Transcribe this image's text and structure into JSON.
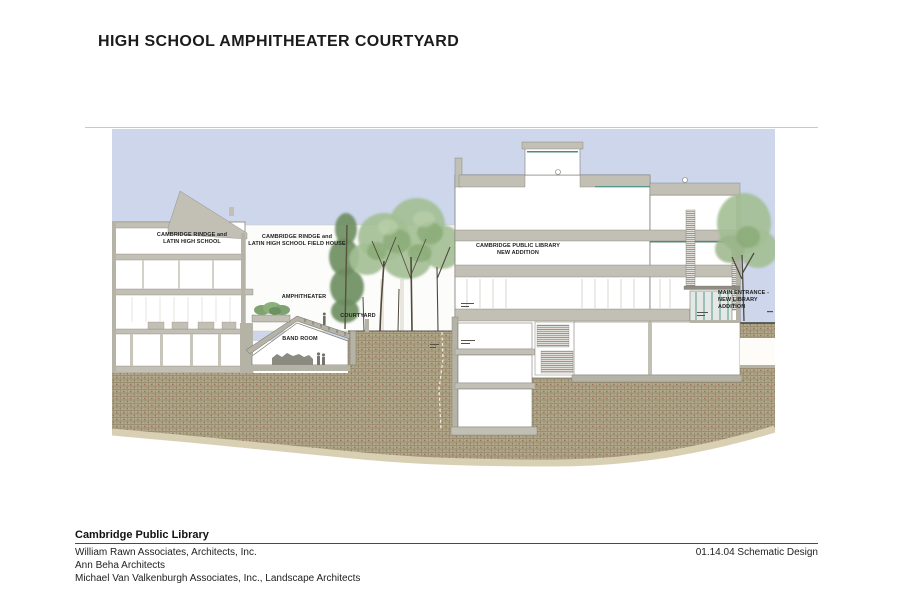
{
  "title": "HIGH SCHOOL AMPHITHEATER COURTYARD",
  "drawing": {
    "type": "architectural-section",
    "labels": {
      "high_school": "CAMBRIDGE RINDGE and\nLATIN HIGH SCHOOL",
      "field_house": "CAMBRIDGE RINDGE and\nLATIN HIGH SCHOOL FIELD HOUSE",
      "amphitheater": "AMPHITHEATER",
      "courtyard": "COURTYARD",
      "band_room": "BAND ROOM",
      "library_addition": "CAMBRIDGE PUBLIC LIBRARY\nNEW ADDITION",
      "main_entrance": "MAIN ENTRANCE -\nNEW LIBRARY\nADDITION"
    },
    "colors": {
      "sky": "#cdd6eb",
      "earth": "#b2a78a",
      "earth_hatch": "#9a8f70",
      "poche_gray": "#c2bfb4",
      "tree_green": "#a3bf93",
      "conifer_green": "#6f8f63",
      "teal_accent": "#4f8a82",
      "torn_edge_tan": "#d9d0b4"
    }
  },
  "footer": {
    "project": "Cambridge Public Library",
    "firms": [
      "William Rawn Associates, Architects, Inc.",
      "Ann Beha Architects",
      "Michael Van Valkenburgh Associates, Inc., Landscape Architects"
    ],
    "date_phase": "01.14.04 Schematic Design"
  }
}
